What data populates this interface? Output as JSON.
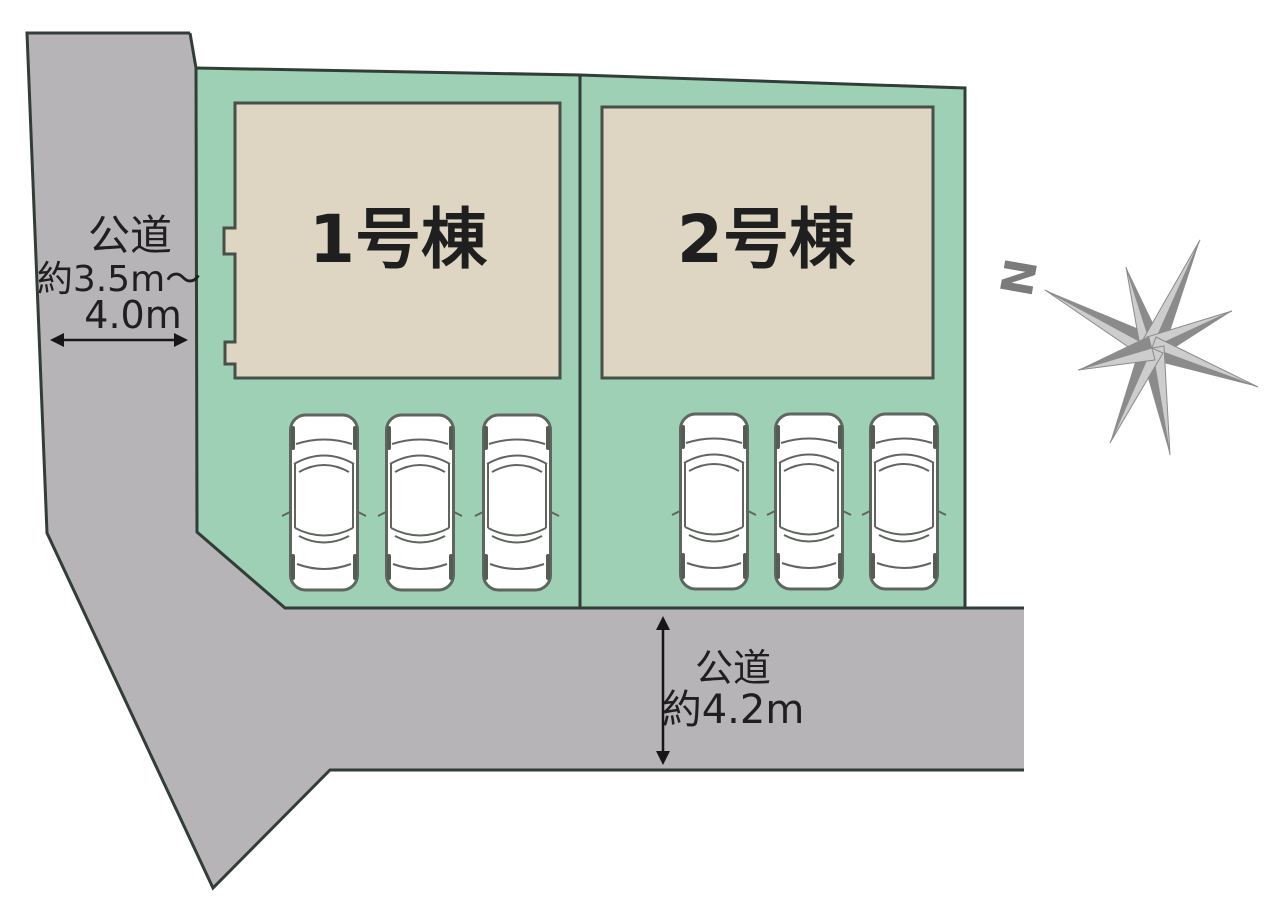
{
  "site": {
    "lot1": {
      "label": "1号棟",
      "parking_count": 3
    },
    "lot2": {
      "label": "2号棟",
      "parking_count": 3
    },
    "west_road": {
      "name": "公道",
      "width_line1": "約3.5m～",
      "width_line2": "4.0m"
    },
    "south_road": {
      "name": "公道",
      "width": "約4.2m"
    },
    "compass": {
      "north": "N"
    }
  },
  "colors": {
    "lot_green": "#9dd0b5",
    "building_beige": "#ded6c3",
    "road_gray": "#b6b4b7",
    "outline_dark": "#333d38",
    "compass_gray": "#8b8b8b",
    "text_dark": "#1f1f1f"
  }
}
